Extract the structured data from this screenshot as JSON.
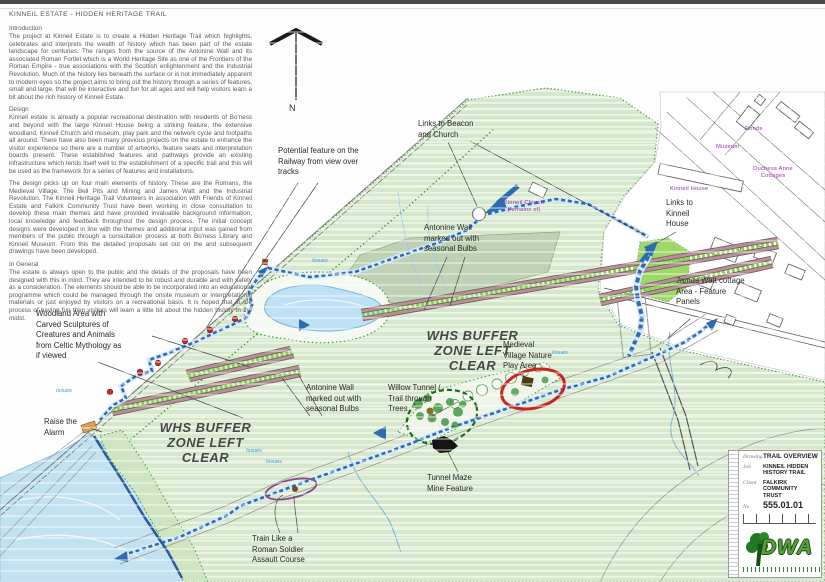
{
  "document": {
    "title": "KINNEIL ESTATE - HIDDEN HERITAGE TRAIL"
  },
  "sections": {
    "introduction": {
      "heading": "Introduction",
      "body": "The project at Kinneil Estate is to create a Hidden Heritage Trail which highlights, celebrates and interprets the wealth of history which has been part of the estate landscape for centuries.  The ranges from the source of the Antonine Wall and its associated Roman Fortlet which is a World Heritage Site as one of the Frontiers of the Roman Empire - true associations with the Scottish enlightenment and the Industrial Revolution.  Much of the history lies beneath the surface or is not immediately apparent to modern eyes so the project aims to bring out the history through a series of features, small and large, that will be interactive and fun for all ages and will help visitors learn a bit about the rich history of Kinneil Estate."
    },
    "design": {
      "heading": "Design",
      "body1": "Kinneil estate is already a popular recreational destination with residents of Bo'ness and beyond with the large Kinneil House being a striking feature, the extensive woodland, Kinneil Church and museum, play park and the network cycle and footpaths all around.  There have also been many previous projects on the estate to enhance the visitor experience so there are a number of artworks, feature seats and interpretation boards present.  These established features and pathways provide an existing infrastructure which lends itself well to the establishment of a specific trail and this will be used as the framework for a series of features and installations.",
      "body2": "The design picks up on four main elements of history.  These are the Romans, the Medieval Village, The Bell Pits and Mining and James Watt and the Industrial Revolution.  The Kinneil Heritage Trail Volunteers in association with Friends of Kinneil Estate and Falkirk Community Trust have been working in close consultation to develop these main themes and have provided invaluable background information, local knowledge and feedback throughout the design process.  The initial concept designs were developed in line with the themes and additional input was gained from members of the public through a consultation process at both Bo'ness Library and Kinneil Museum.  From this the detailed proposals set out on the and subsequent drawings have been developed."
    },
    "general": {
      "heading": "In General",
      "body": "The estate is always open to the public and the details of the proposals have been designed with this in mind.  They are intended to be robust and durable and with safety as a consideration.  The elements should be able to be incorporated into an educational programme which could be managed through the onsite museum or interpretational materials or just enjoyed by visitors on a recreational basis.  It is hoped that in the process of having fun then visitors will learn a little bit about the hidden history in the midst."
    }
  },
  "north_arrow": {
    "label": "N"
  },
  "zones": {
    "whs_buffer": "WHS BUFFER\nZONE LEFT\nCLEAR"
  },
  "annotations": {
    "potential_feature": "Potential feature on the\nRailway from view over\ntracks",
    "links_beacon": "Links to Beacon\nand Church",
    "antonine_wall_upper": "Antonine Wall\nmarked out with\nseasonal Bulbs",
    "links_kinneil_house": "Links to\nKinneil\nHouse",
    "james_watt": "James Watt cottage\nArea -  Feature\nPanels",
    "woodland_sculptures": "Woodland Area with\nCarved Sculptures of\nCreatures and Animals\nfrom Celtic Mythology as\nif viewed",
    "medieval_village": "Medieval\nVillage Nature\nPlay Area",
    "willow_tunnel": "Willow Tunnel /\nTrail through\nTrees",
    "antonine_wall_lower": "Antonine Wall\nmarked out with\nseasonal Bulbs",
    "raise_alarm": "Raise the\nAlarm",
    "tunnel_maze": "Tunnel Maze\nMine Feature",
    "train_roman": "Train Like a\nRoman Soldier\nAssault Course"
  },
  "map_labels": {
    "kinneil_church": "Kinneil Church\n(remains of)",
    "ponds": "Ponds",
    "museum": "Museum",
    "duchess_anne": "Duchess Anne\nCottages",
    "kinneil_house": "Kinneil House",
    "issues": "Issues"
  },
  "title_block": {
    "rows": [
      {
        "label": "Drawing",
        "value": "TRAIL OVERVIEW"
      },
      {
        "label": "Job",
        "value": "KINNEIL HIDDEN\nHISTORY TRAIL"
      },
      {
        "label": "Client",
        "value": "FALKIRK COMMUNITY\nTRUST"
      },
      {
        "label": "No",
        "value": "555.01.01"
      }
    ],
    "logo": "DWA"
  },
  "colors": {
    "map_green": "#d6e8cc",
    "woodland_green": "#cfe5c2",
    "olive_green": "#bccfb2",
    "water_blue": "#c2e2f2",
    "trail_blue": "#2e6cb0",
    "wall_brown": "#a58083",
    "bulb_green": "#86d34f",
    "marker_red": "#c03028",
    "label_purple": "#9b30b0",
    "issues_blue": "#2e9bd6",
    "logo_green": "#5a9e3a"
  }
}
